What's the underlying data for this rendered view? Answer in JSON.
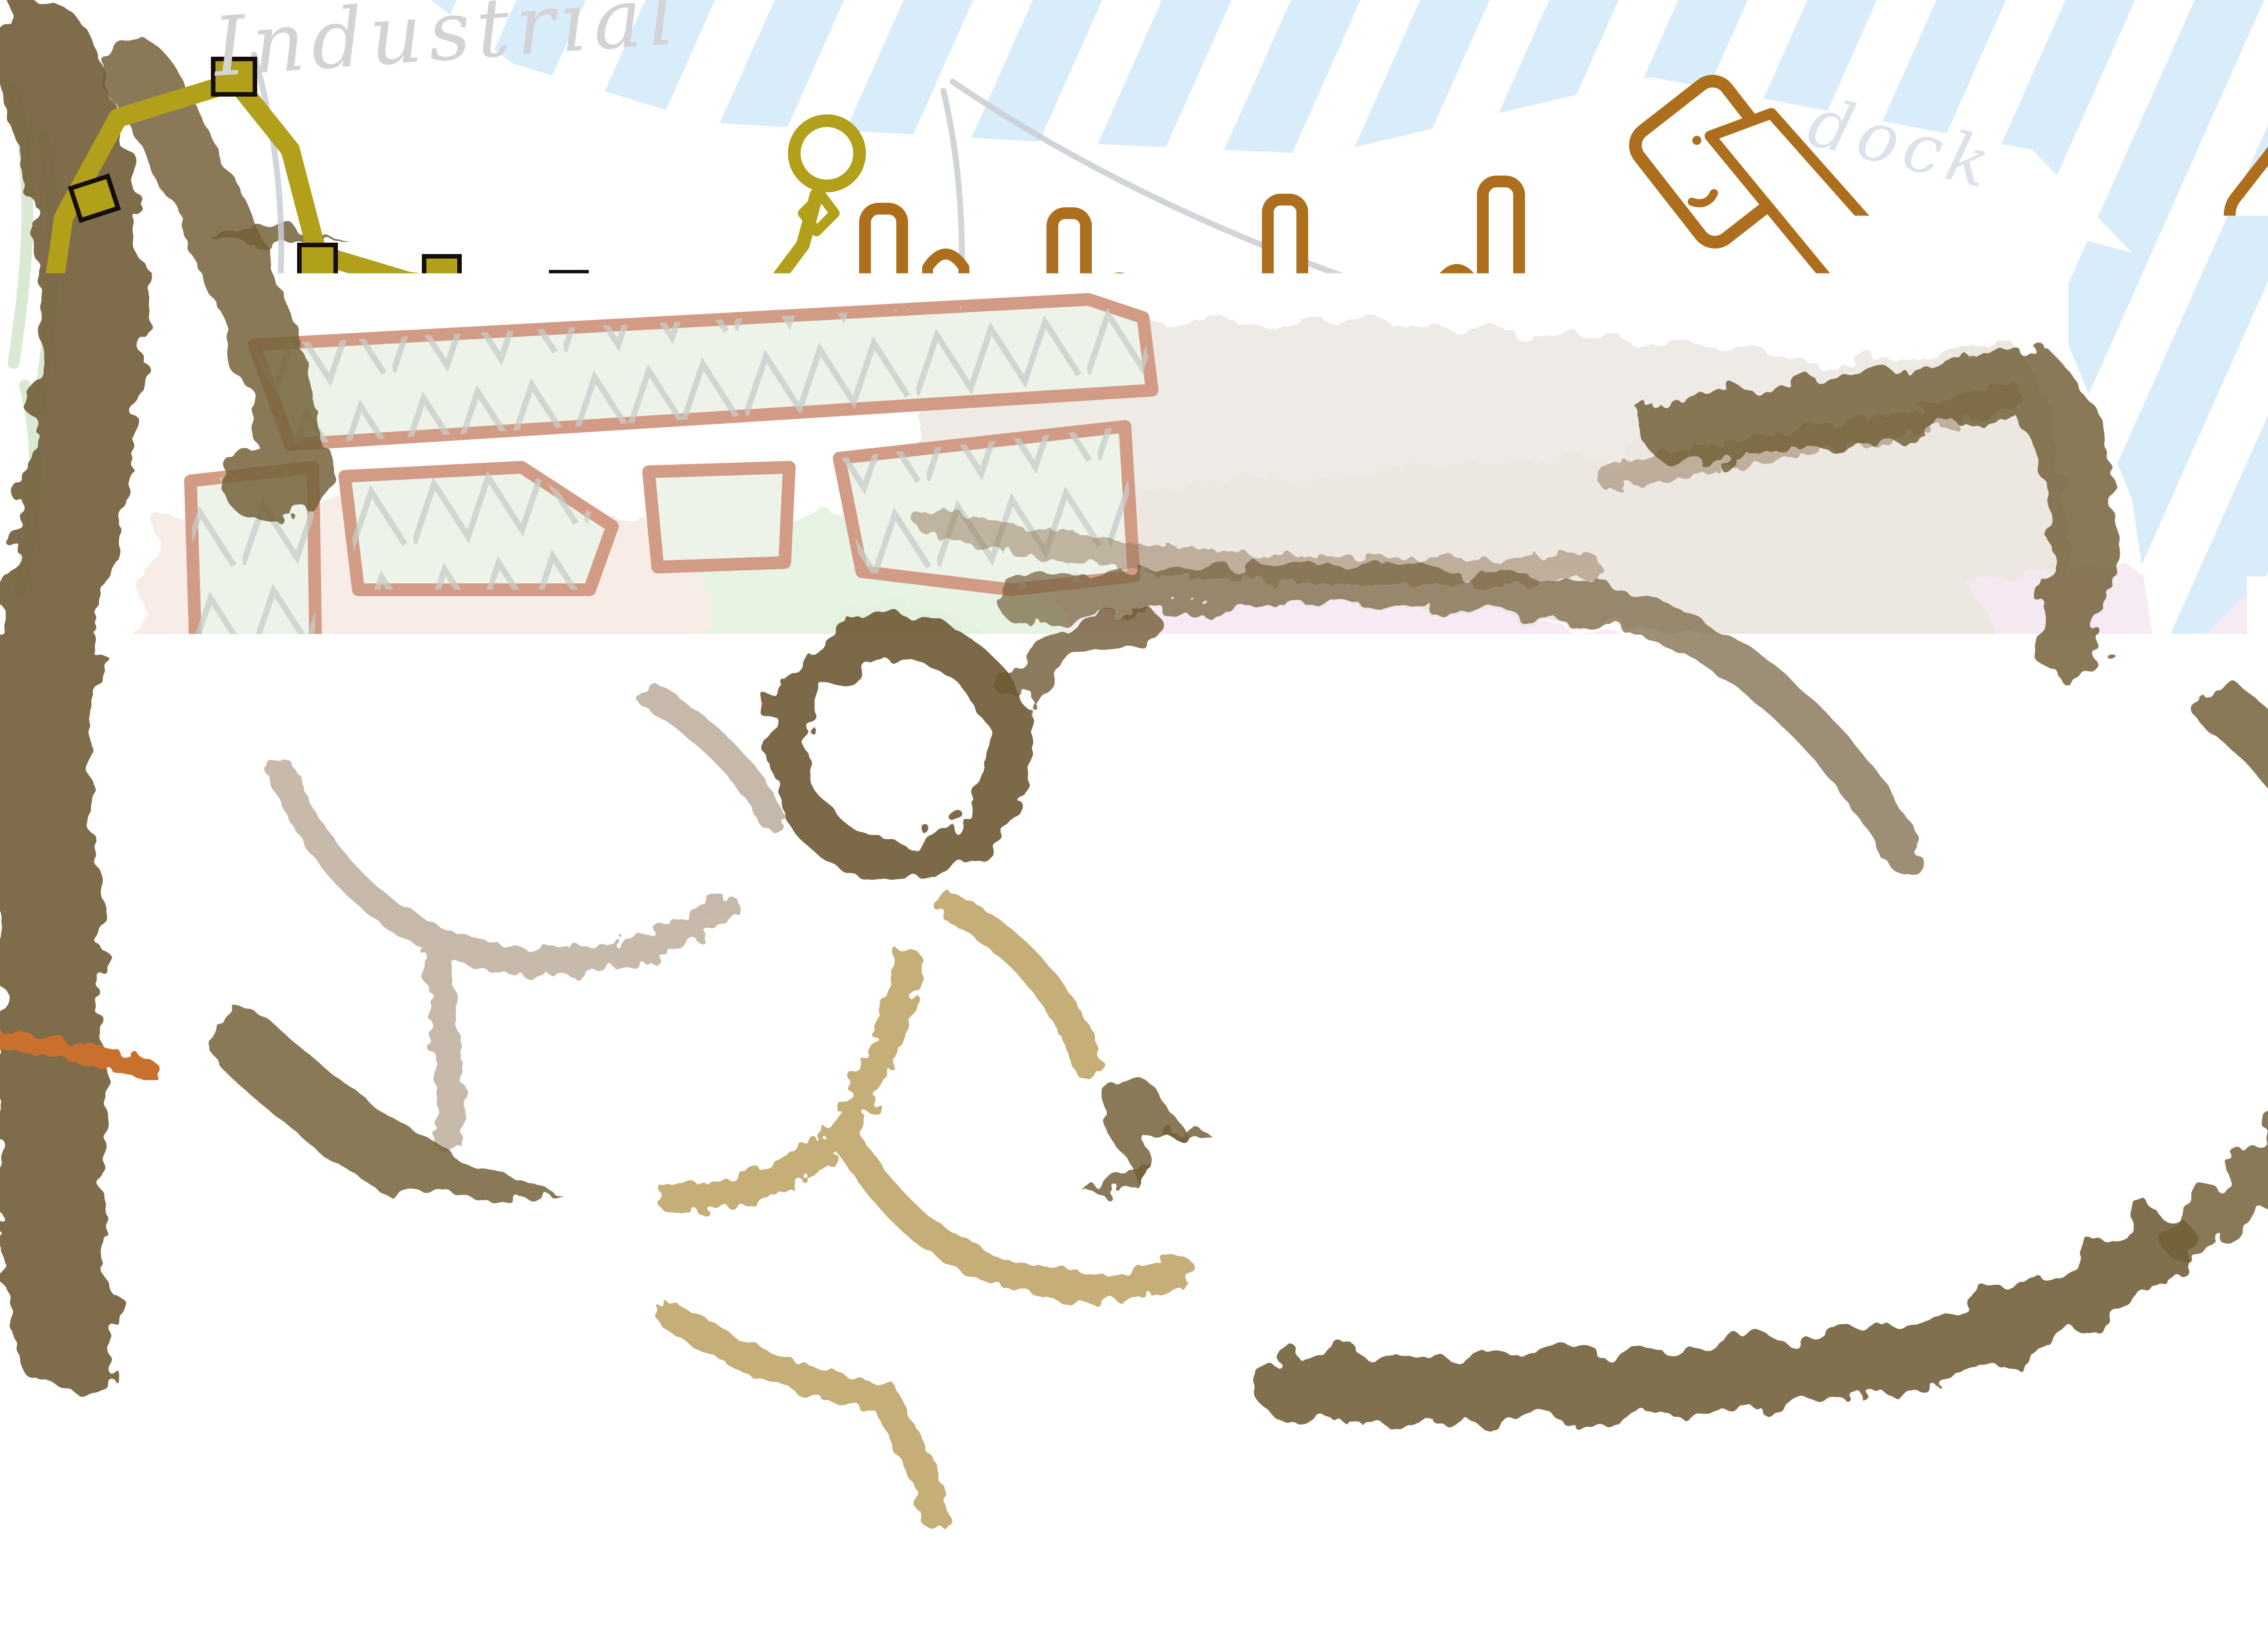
{
  "map": {
    "type": "hand-drawn fantasy city plan",
    "labels": {
      "industrial": "Industrial",
      "dock": "dock",
      "castle": "Castle",
      "high_wage": "High wage",
      "beach": "Beach"
    },
    "palette": {
      "water_blue": "#d9ecfa",
      "forest_brown": "#74603a",
      "forest_dark": "#584626",
      "wall_olive": "#b2a01b",
      "dock_brown": "#ad6f1d",
      "warehouse_gray": "#7e7e82",
      "arena_pink": "#f8eaf4",
      "arena_arc_brown": "#bf7434",
      "field_green": "#edf3e9",
      "field_outline_salmon": "#d29b85",
      "grove_green": "#e3f3df",
      "stone_gray": "#6b6e73",
      "henge_orange": "#f59a5e",
      "old_town_tan": "#c9a286",
      "old_town_brown": "#9a6a4b",
      "old_town_dark": "#7c5233",
      "old_town_ochre": "#b07d2a",
      "new_town_light": "#f09a5f",
      "new_town_dark": "#cf6b24",
      "castle_roof_light": "#f4a066",
      "castle_roof_rust": "#c05f2a",
      "courtyard_green": "#63a24d",
      "street_lavender": "#e9e6f4",
      "ground_pink": "#f8ece6",
      "beach_sand": "#fbf7d8",
      "dirt_path": "#a8832f",
      "route_arrow_magenta": "#ef1fbe",
      "pencil_gray": "#c9ced2",
      "outline_black": "#140e06"
    }
  }
}
